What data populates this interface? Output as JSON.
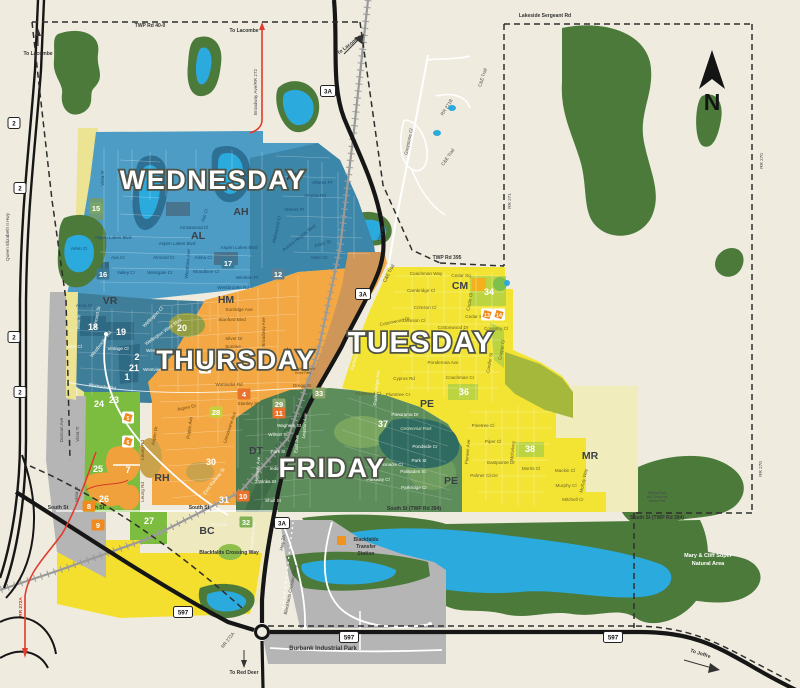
{
  "compass": {
    "label": "N"
  },
  "day_zones": [
    {
      "name": "WEDNESDAY",
      "x": 213,
      "y": 189,
      "size": 27
    },
    {
      "name": "THURSDAY",
      "x": 236,
      "y": 369,
      "size": 27
    },
    {
      "name": "TUESDAY",
      "x": 421,
      "y": 352,
      "size": 29
    },
    {
      "name": "FRIDAY",
      "x": 332,
      "y": 477,
      "size": 27
    }
  ],
  "area_codes": [
    {
      "code": "AL",
      "x": 128,
      "y": 186
    },
    {
      "code": "AH",
      "x": 294,
      "y": 180
    },
    {
      "code": "AH",
      "x": 241,
      "y": 215
    },
    {
      "code": "AL",
      "x": 198,
      "y": 239
    },
    {
      "code": "VR",
      "x": 110,
      "y": 304
    },
    {
      "code": "HM",
      "x": 226,
      "y": 303
    },
    {
      "code": "CM",
      "x": 460,
      "y": 289
    },
    {
      "code": "DT",
      "x": 256,
      "y": 454
    },
    {
      "code": "RH",
      "x": 162,
      "y": 481
    },
    {
      "code": "PE",
      "x": 427,
      "y": 407
    },
    {
      "code": "PE",
      "x": 451,
      "y": 484
    },
    {
      "code": "BC",
      "x": 207,
      "y": 534
    },
    {
      "code": "MR",
      "x": 590,
      "y": 459
    }
  ],
  "markers": [
    {
      "n": "1",
      "x": 127,
      "y": 380,
      "s": "plain"
    },
    {
      "n": "2",
      "x": 137,
      "y": 360,
      "s": "plain"
    },
    {
      "n": "12",
      "x": 278,
      "y": 277,
      "s": "chip",
      "bg": "#5c7f91"
    },
    {
      "n": "15",
      "x": 96,
      "y": 211,
      "s": "chip",
      "bg": "#79a668"
    },
    {
      "n": "16",
      "x": 103,
      "y": 277,
      "s": "chip",
      "bg": "#3a7a97"
    },
    {
      "n": "17",
      "x": 228,
      "y": 266,
      "s": "chip",
      "bg": "#3a7a97"
    },
    {
      "n": "18",
      "x": 93,
      "y": 330,
      "s": "plain"
    },
    {
      "n": "19",
      "x": 121,
      "y": 335,
      "s": "plain"
    },
    {
      "n": "20",
      "x": 182,
      "y": 331,
      "s": "plain"
    },
    {
      "n": "21",
      "x": 134,
      "y": 371,
      "s": "plain"
    },
    {
      "n": "23",
      "x": 114,
      "y": 403,
      "s": "plain"
    },
    {
      "n": "24",
      "x": 99,
      "y": 407,
      "s": "plain"
    },
    {
      "n": "25",
      "x": 98,
      "y": 472,
      "s": "plain"
    },
    {
      "n": "26",
      "x": 104,
      "y": 502,
      "s": "plain"
    },
    {
      "n": "27",
      "x": 149,
      "y": 524,
      "s": "plain"
    },
    {
      "n": "28",
      "x": 216,
      "y": 415,
      "s": "chip",
      "bg": "#c8cf3f"
    },
    {
      "n": "29",
      "x": 279,
      "y": 407,
      "s": "chip",
      "bg": "#8aa668"
    },
    {
      "n": "30",
      "x": 211,
      "y": 465,
      "s": "plain"
    },
    {
      "n": "31",
      "x": 224,
      "y": 503,
      "s": "plain"
    },
    {
      "n": "32",
      "x": 246,
      "y": 525,
      "s": "chip",
      "bg": "#7fb254"
    },
    {
      "n": "33",
      "x": 319,
      "y": 396,
      "s": "chip",
      "bg": "#8aa668"
    },
    {
      "n": "34",
      "x": 489,
      "y": 295,
      "s": "plain"
    },
    {
      "n": "36",
      "x": 464,
      "y": 395,
      "s": "plain"
    },
    {
      "n": "37",
      "x": 383,
      "y": 427,
      "s": "plain"
    },
    {
      "n": "38",
      "x": 530,
      "y": 452,
      "s": "plain"
    },
    {
      "n": "3",
      "x": 205,
      "y": 371,
      "s": "badge"
    },
    {
      "n": "4",
      "x": 244,
      "y": 397,
      "s": "chip",
      "bg": "#e8732c"
    },
    {
      "n": "5",
      "x": 128,
      "y": 421,
      "s": "badge"
    },
    {
      "n": "6",
      "x": 128,
      "y": 445,
      "s": "badge"
    },
    {
      "n": "7",
      "x": 128,
      "y": 473,
      "s": "plain"
    },
    {
      "n": "8",
      "x": 89,
      "y": 509,
      "s": "chip",
      "bg": "#ef8b1f"
    },
    {
      "n": "9",
      "x": 98,
      "y": 528,
      "s": "chip",
      "bg": "#ef8b1f"
    },
    {
      "n": "10",
      "x": 243,
      "y": 499,
      "s": "chip",
      "bg": "#e8732c"
    },
    {
      "n": "11",
      "x": 279,
      "y": 416,
      "s": "chip",
      "bg": "#e8732c"
    },
    {
      "n": "13",
      "x": 487,
      "y": 318,
      "s": "badge"
    },
    {
      "n": "14",
      "x": 499,
      "y": 318,
      "s": "badge"
    }
  ],
  "shields": [
    {
      "t": "2",
      "x": 14,
      "y": 123
    },
    {
      "t": "2",
      "x": 20,
      "y": 188
    },
    {
      "t": "2",
      "x": 14,
      "y": 337
    },
    {
      "t": "2",
      "x": 20,
      "y": 392
    },
    {
      "t": "3A",
      "x": 328,
      "y": 91
    },
    {
      "t": "3A",
      "x": 363,
      "y": 294
    },
    {
      "t": "3A",
      "x": 282,
      "y": 523
    },
    {
      "t": "597",
      "x": 183,
      "y": 612
    },
    {
      "t": "597",
      "x": 349,
      "y": 637
    },
    {
      "t": "597",
      "x": 613,
      "y": 637
    }
  ],
  "texts": [
    {
      "t": "Vista Tr",
      "x": 104,
      "y": 178,
      "r": -90,
      "c": "b"
    },
    {
      "t": "Anna Cl",
      "x": 84,
      "y": 307,
      "c": "b"
    },
    {
      "t": "Aspen Lakes Blvd",
      "x": 113,
      "y": 239,
      "c": "b"
    },
    {
      "t": "Aspen Lakes Blvd",
      "x": 177,
      "y": 245,
      "c": "b"
    },
    {
      "t": "Aspen Lakes Blvd",
      "x": 239,
      "y": 249,
      "c": "b"
    },
    {
      "t": "Arlen Cl",
      "x": 79,
      "y": 250,
      "c": "b"
    },
    {
      "t": "Ava Cr",
      "x": 118,
      "y": 259,
      "c": "b"
    },
    {
      "t": "Valley Cr",
      "x": 126,
      "y": 274,
      "c": "b"
    },
    {
      "t": "Westgate Cr",
      "x": 160,
      "y": 274,
      "c": "b"
    },
    {
      "t": "Almond Cr",
      "x": 164,
      "y": 259,
      "c": "b"
    },
    {
      "t": "Adina Cl",
      "x": 203,
      "y": 259,
      "c": "b"
    },
    {
      "t": "Woodbine Cl",
      "x": 206,
      "y": 273,
      "c": "b"
    },
    {
      "t": "Arrowwood Cl",
      "x": 194,
      "y": 229,
      "c": "b"
    },
    {
      "t": "Ash Cl",
      "x": 206,
      "y": 216,
      "r": -72,
      "c": "b"
    },
    {
      "t": "Winston Pl",
      "x": 247,
      "y": 279,
      "c": "b"
    },
    {
      "t": "Westbrooke Rd",
      "x": 233,
      "y": 289,
      "c": "b"
    },
    {
      "t": "Athens Pl",
      "x": 322,
      "y": 184,
      "c": "b"
    },
    {
      "t": "Athens Pl",
      "x": 294,
      "y": 211,
      "c": "b"
    },
    {
      "t": "Athena Rd",
      "x": 315,
      "y": 197,
      "c": "b"
    },
    {
      "t": "Aurora Heights Blvd",
      "x": 300,
      "y": 239,
      "r": -38,
      "c": "b"
    },
    {
      "t": "Aztec St",
      "x": 323,
      "y": 245,
      "r": -15,
      "c": "b"
    },
    {
      "t": "Aztec Cr",
      "x": 319,
      "y": 259,
      "c": "b"
    },
    {
      "t": "Alderwood Cl",
      "x": 278,
      "y": 230,
      "r": -78,
      "c": "b"
    },
    {
      "t": "Woodbine Ave",
      "x": 189,
      "y": 264,
      "r": -85,
      "c": "b"
    },
    {
      "t": "Vermont St",
      "x": 98,
      "y": 318,
      "r": -78,
      "c": "w"
    },
    {
      "t": "Vista Tr",
      "x": 80,
      "y": 322,
      "r": -85,
      "c": "w"
    },
    {
      "t": "Vista Cl",
      "x": 74,
      "y": 348,
      "c": "w"
    },
    {
      "t": "Vintage Cl",
      "x": 118,
      "y": 350,
      "c": "w"
    },
    {
      "t": "Westbrooke Rd",
      "x": 102,
      "y": 345,
      "r": -52,
      "c": "w"
    },
    {
      "t": "Womacks Rd",
      "x": 102,
      "y": 388,
      "r": 8,
      "c": "w"
    },
    {
      "t": "Wellington Cl",
      "x": 154,
      "y": 318,
      "r": -45,
      "c": "w"
    },
    {
      "t": "Wellington West Blvd",
      "x": 164,
      "y": 333,
      "r": -35,
      "c": "w"
    },
    {
      "t": "Westview Cr",
      "x": 159,
      "y": 352,
      "c": "w"
    },
    {
      "t": "Westview Cr",
      "x": 156,
      "y": 371,
      "c": "w"
    },
    {
      "t": "Sunridge Ave",
      "x": 239,
      "y": 311,
      "c": "o"
    },
    {
      "t": "Stanford Blvd",
      "x": 232,
      "y": 321,
      "c": "o"
    },
    {
      "t": "Silver Dr",
      "x": 234,
      "y": 340,
      "c": "o"
    },
    {
      "t": "Sunrise",
      "x": 233,
      "y": 348,
      "c": "o"
    },
    {
      "t": "Womacks Rd",
      "x": 229,
      "y": 386,
      "c": "o"
    },
    {
      "t": "Gregg St",
      "x": 302,
      "y": 387,
      "c": "o"
    },
    {
      "t": "Stanley St",
      "x": 248,
      "y": 405,
      "c": "o"
    },
    {
      "t": "Aspen Dr",
      "x": 187,
      "y": 409,
      "r": -12,
      "c": "o"
    },
    {
      "t": "Aspen Dr",
      "x": 156,
      "y": 436,
      "r": -80,
      "c": "o"
    },
    {
      "t": "Poplar Ave",
      "x": 191,
      "y": 428,
      "r": -82,
      "c": "o"
    },
    {
      "t": "Lansdowne Ave",
      "x": 231,
      "y": 428,
      "r": -72,
      "c": "o"
    },
    {
      "t": "Leung Rd",
      "x": 144,
      "y": 450,
      "r": -90,
      "c": "o"
    },
    {
      "t": "Leung Rd",
      "x": 144,
      "y": 492,
      "r": -90,
      "c": "o"
    },
    {
      "t": "Broadway Ave",
      "x": 265,
      "y": 332,
      "r": -90,
      "c": "o"
    },
    {
      "t": "Blackfalds Mobile",
      "x": 303,
      "y": 370,
      "c": "o",
      "s": 3.2
    },
    {
      "t": "Home Park",
      "x": 303,
      "y": 374,
      "c": "o",
      "s": 3.2
    },
    {
      "t": "Waghorn St",
      "x": 289,
      "y": 427,
      "c": "w"
    },
    {
      "t": "Wilson St",
      "x": 278,
      "y": 436,
      "c": "w"
    },
    {
      "t": "Park St",
      "x": 278,
      "y": 453,
      "c": "w"
    },
    {
      "t": "Indiana St",
      "x": 280,
      "y": 470,
      "c": "w"
    },
    {
      "t": "Winks St",
      "x": 267,
      "y": 483,
      "c": "w"
    },
    {
      "t": "Shull St",
      "x": 273,
      "y": 502,
      "c": "w"
    },
    {
      "t": "Trout St",
      "x": 219,
      "y": 526,
      "c": "w"
    },
    {
      "t": "East Railway St",
      "x": 215,
      "y": 482,
      "r": -52,
      "c": "w"
    },
    {
      "t": "East Ave",
      "x": 298,
      "y": 444,
      "r": -85,
      "c": "w"
    },
    {
      "t": "Leaston Ave",
      "x": 306,
      "y": 426,
      "r": -85,
      "c": "w"
    },
    {
      "t": "Highway Ave",
      "x": 259,
      "y": 470,
      "r": -85,
      "c": "w"
    },
    {
      "t": "Broadway Ave",
      "x": 254,
      "y": 537,
      "r": -85,
      "c": "w"
    },
    {
      "t": "Panorama Dr",
      "x": 405,
      "y": 416,
      "c": "w"
    },
    {
      "t": "Centennial Park",
      "x": 416,
      "y": 430,
      "c": "p"
    },
    {
      "t": "Pondside Cr",
      "x": 425,
      "y": 448,
      "c": "w"
    },
    {
      "t": "Park St",
      "x": 419,
      "y": 462,
      "c": "w"
    },
    {
      "t": "Pinnacle Cl",
      "x": 391,
      "y": 466,
      "c": "w"
    },
    {
      "t": "Palisades St",
      "x": 413,
      "y": 473,
      "c": "w"
    },
    {
      "t": "Parkway Cl",
      "x": 378,
      "y": 481,
      "c": "w"
    },
    {
      "t": "Parkridge Cr",
      "x": 414,
      "y": 489,
      "c": "w"
    },
    {
      "t": "Prairie Ridge Ave",
      "x": 378,
      "y": 388,
      "r": -85,
      "c": "w"
    },
    {
      "t": "Parkwood Rd",
      "x": 357,
      "y": 357,
      "r": -75,
      "c": "w"
    },
    {
      "t": "Pinewood Cl",
      "x": 368,
      "y": 395,
      "c": "y"
    },
    {
      "t": "Plumtree Cr",
      "x": 398,
      "y": 396,
      "c": "y"
    },
    {
      "t": "Cyprus Rd",
      "x": 404,
      "y": 380,
      "c": "y"
    },
    {
      "t": "Coachman Way",
      "x": 426,
      "y": 275,
      "c": "y"
    },
    {
      "t": "Cedar Sq",
      "x": 461,
      "y": 277,
      "c": "y"
    },
    {
      "t": "Cedar Sq",
      "x": 475,
      "y": 318,
      "c": "y"
    },
    {
      "t": "Cedar Cl",
      "x": 471,
      "y": 302,
      "r": -80,
      "c": "y"
    },
    {
      "t": "Cambridge Cl",
      "x": 421,
      "y": 292,
      "c": "y"
    },
    {
      "t": "Crimson Cl",
      "x": 425,
      "y": 309,
      "c": "y"
    },
    {
      "t": "Crimson Cl",
      "x": 414,
      "y": 322,
      "c": "y"
    },
    {
      "t": "Cottonwood Dr",
      "x": 395,
      "y": 323,
      "r": -12,
      "c": "y"
    },
    {
      "t": "Cottonwood Dr",
      "x": 453,
      "y": 329,
      "c": "y"
    },
    {
      "t": "Churchill Pl",
      "x": 432,
      "y": 339,
      "c": "y"
    },
    {
      "t": "Coventry Cl",
      "x": 496,
      "y": 330,
      "c": "y"
    },
    {
      "t": "Cooper Cl",
      "x": 503,
      "y": 350,
      "r": -80,
      "c": "y"
    },
    {
      "t": "Conifer St",
      "x": 491,
      "y": 363,
      "r": -80,
      "c": "y"
    },
    {
      "t": "Coachman Cr",
      "x": 460,
      "y": 379,
      "c": "y"
    },
    {
      "t": "Ponderosa Ave",
      "x": 443,
      "y": 364,
      "c": "y"
    },
    {
      "t": "Pinetree Cl",
      "x": 483,
      "y": 427,
      "c": "y"
    },
    {
      "t": "Piper Cl",
      "x": 493,
      "y": 443,
      "c": "y"
    },
    {
      "t": "Eastpointe Dr",
      "x": 501,
      "y": 464,
      "c": "y"
    },
    {
      "t": "Palmer Circle",
      "x": 484,
      "y": 477,
      "c": "y"
    },
    {
      "t": "Pioneer Ave",
      "x": 469,
      "y": 452,
      "r": -85,
      "c": "y"
    },
    {
      "t": "McKelvey",
      "x": 514,
      "y": 451,
      "r": -85,
      "c": "y"
    },
    {
      "t": "Morris Cl",
      "x": 531,
      "y": 470,
      "c": "y"
    },
    {
      "t": "Mitchell Cr",
      "x": 573,
      "y": 501,
      "c": "y"
    },
    {
      "t": "Murphy Cl",
      "x": 566,
      "y": 487,
      "c": "y"
    },
    {
      "t": "Mackin Cl",
      "x": 565,
      "y": 472,
      "c": "y"
    },
    {
      "t": "McKay Way",
      "x": 585,
      "y": 481,
      "r": -78,
      "c": "y"
    },
    {
      "t": "McKay Place",
      "x": 657,
      "y": 494,
      "c": "k",
      "s": 3.2
    },
    {
      "t": "Ball Diamonds",
      "x": 657,
      "y": 498,
      "c": "k",
      "s": 3.2
    },
    {
      "t": "Jubilee Park",
      "x": 657,
      "y": 502,
      "c": "k",
      "s": 3.2
    },
    {
      "t": "Greystone Cl",
      "x": 410,
      "y": 142,
      "r": -78,
      "c": "k"
    },
    {
      "t": "C&E Trail",
      "x": 484,
      "y": 78,
      "r": -72,
      "c": "k"
    },
    {
      "t": "C&E Trail",
      "x": 449,
      "y": 158,
      "r": -55,
      "c": "k"
    },
    {
      "t": "C&E Trail",
      "x": 390,
      "y": 274,
      "r": -62,
      "c": "k"
    },
    {
      "t": "RR 271B",
      "x": 448,
      "y": 108,
      "r": -58,
      "c": "k"
    },
    {
      "t": "RR 271",
      "x": 511,
      "y": 201,
      "r": -90,
      "c": "k"
    },
    {
      "t": "RR 270",
      "x": 763,
      "y": 161,
      "r": -90,
      "c": "k"
    },
    {
      "t": "RR 270",
      "x": 762,
      "y": 469,
      "r": -90,
      "c": "k"
    },
    {
      "t": "Lakeside Sergeant Rd",
      "x": 545,
      "y": 17,
      "c": "kb"
    },
    {
      "t": "TWP Rd 40-0",
      "x": 150,
      "y": 27,
      "c": "kb"
    },
    {
      "t": "TWP Rd 395",
      "x": 447,
      "y": 259,
      "c": "kb"
    },
    {
      "t": "South St (TWP Rd 394)",
      "x": 414,
      "y": 510,
      "c": "kb"
    },
    {
      "t": "South St (TWP Rd 394)",
      "x": 657,
      "y": 519,
      "c": "kb"
    },
    {
      "t": "South St",
      "x": 58,
      "y": 509,
      "c": "kb"
    },
    {
      "t": "South St",
      "x": 94,
      "y": 509,
      "c": "kb"
    },
    {
      "t": "South St",
      "x": 199,
      "y": 509,
      "c": "kb"
    },
    {
      "t": "Queen Elizabeth II Hwy",
      "x": 9,
      "y": 237,
      "r": -90,
      "c": "k"
    },
    {
      "t": "Hwy 2A",
      "x": 382,
      "y": 234,
      "r": -72,
      "c": "k"
    },
    {
      "t": "Hwy 2A",
      "x": 284,
      "y": 543,
      "r": -80,
      "c": "k"
    },
    {
      "t": "Broadway Ave/RR 272",
      "x": 257,
      "y": 92,
      "r": -90,
      "c": "k"
    },
    {
      "t": "Duncan Ave",
      "x": 63,
      "y": 430,
      "r": -90,
      "c": "k"
    },
    {
      "t": "Vista Tr",
      "x": 79,
      "y": 434,
      "r": -90,
      "c": "k"
    },
    {
      "t": "Vista Tr",
      "x": 78,
      "y": 494,
      "r": -90,
      "c": "k"
    },
    {
      "t": "RR 272A",
      "x": 22,
      "y": 607,
      "r": -90,
      "c": "r"
    },
    {
      "t": "RR 272A",
      "x": 229,
      "y": 641,
      "r": -52,
      "c": "k"
    },
    {
      "t": "To Lacombe",
      "x": 38,
      "y": 55,
      "c": "kb"
    },
    {
      "t": "To Lacombe",
      "x": 244,
      "y": 32,
      "c": "kb"
    },
    {
      "t": "To Lacombe",
      "x": 350,
      "y": 46,
      "r": -38,
      "c": "kb"
    },
    {
      "t": "To Red Deer",
      "x": 244,
      "y": 674,
      "c": "kb"
    },
    {
      "t": "To Joffre",
      "x": 700,
      "y": 655,
      "r": 18,
      "c": "kb"
    },
    {
      "t": "Burbank Industrial Park",
      "x": 323,
      "y": 650,
      "c": "kb",
      "s": 6
    },
    {
      "t": "Blackfalds Crossing Way",
      "x": 229,
      "y": 554,
      "c": "kb"
    },
    {
      "t": "Blackfalds Crossing Way",
      "x": 292,
      "y": 590,
      "r": -78,
      "c": "k"
    },
    {
      "t": "Mary & Cliff Soper",
      "x": 708,
      "y": 557,
      "c": "wb"
    },
    {
      "t": "Natural Area",
      "x": 708,
      "y": 565,
      "c": "wb"
    },
    {
      "t": "Blackfalds",
      "x": 366,
      "y": 541,
      "c": "kb"
    },
    {
      "t": "Transfer",
      "x": 366,
      "y": 548,
      "c": "kb"
    },
    {
      "t": "Station",
      "x": 366,
      "y": 555,
      "c": "kb"
    }
  ]
}
